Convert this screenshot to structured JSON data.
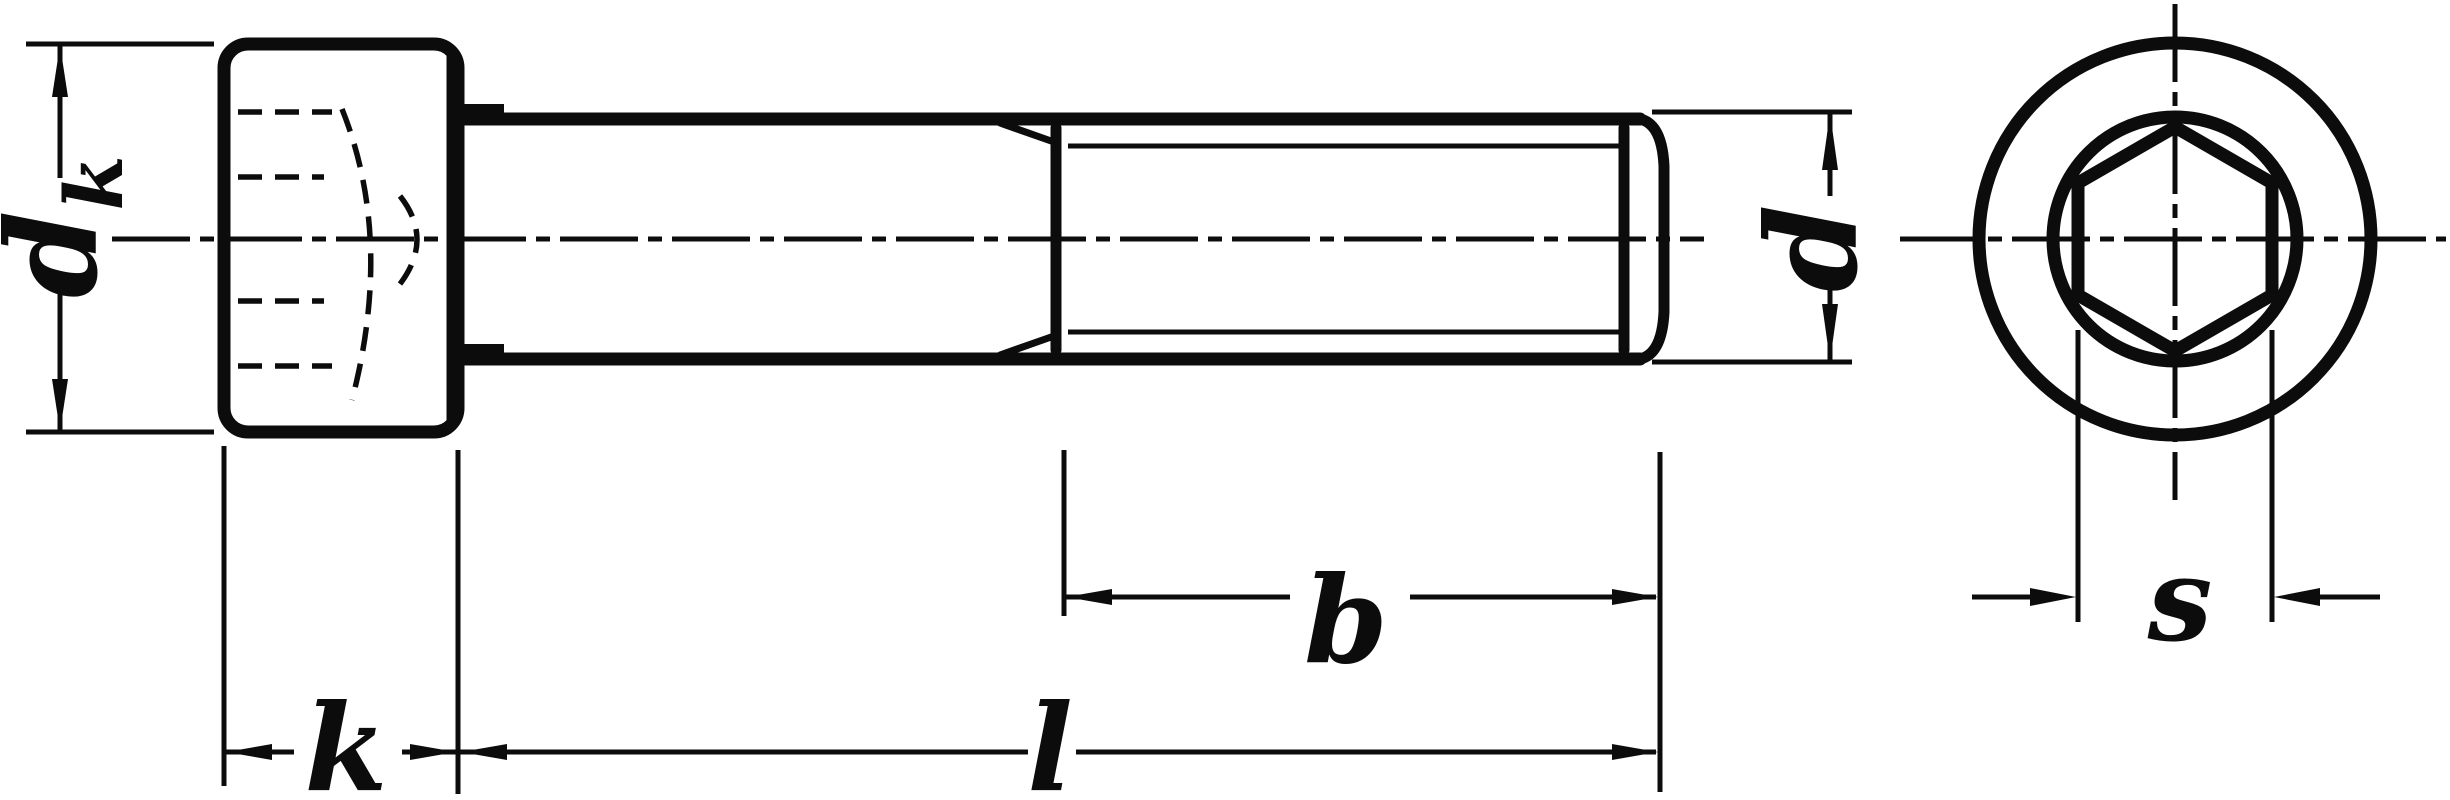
{
  "drawing": {
    "colors": {
      "ink": "#0c0c0c",
      "paper": "#ffffff"
    },
    "dimensions": {
      "head_diameter": {
        "base": "d",
        "sub": "k"
      },
      "head_height": {
        "label": "k"
      },
      "total_length": {
        "label": "l"
      },
      "thread_length": {
        "label": "b"
      },
      "thread_diameter": {
        "label": "d"
      },
      "socket_width": {
        "label": "s"
      }
    }
  }
}
